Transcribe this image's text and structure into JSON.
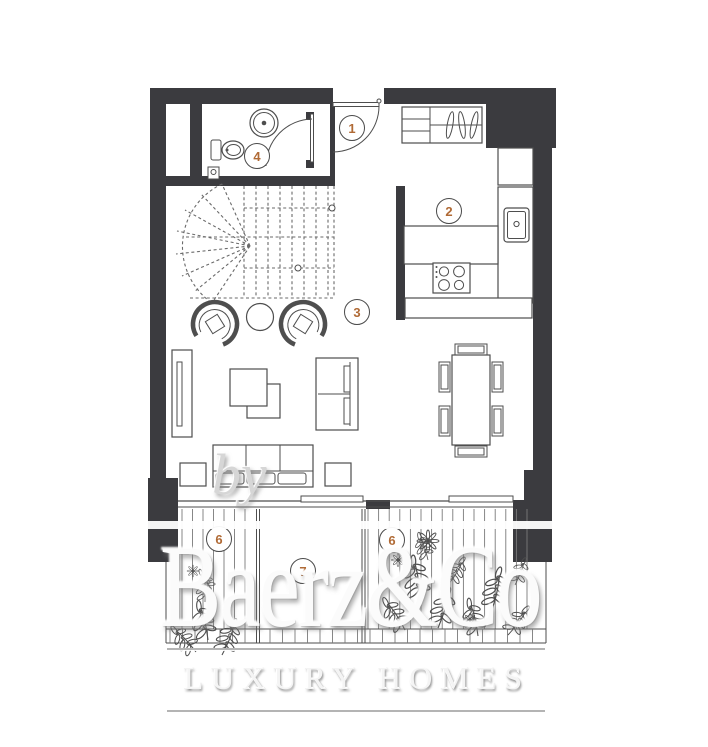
{
  "watermark": {
    "prefix": "by",
    "brand": "Baerz&Co",
    "tagline": "LUXURY HOMES"
  },
  "room_labels": [
    {
      "number": "1",
      "name": "entrance-hall"
    },
    {
      "number": "2",
      "name": "kitchen"
    },
    {
      "number": "3",
      "name": "living-room"
    },
    {
      "number": "4",
      "name": "bathroom"
    },
    {
      "number": "6",
      "name": "balcony-left"
    },
    {
      "number": "6",
      "name": "balcony-right"
    },
    {
      "number": "7",
      "name": "terrace-middle"
    }
  ],
  "colors": {
    "wall": "#3b3b3f",
    "furniture_line": "#4e4e4e",
    "stair_line": "#6a6a6a",
    "label_digit": "#b06a35",
    "label_ring": "#4a4a4a",
    "watermark_rule": "#b4b4b4"
  },
  "fixtures": [
    "spiral-staircase",
    "toilet",
    "washbasin",
    "entry-door",
    "bathroom-door",
    "wardrobe-hangers",
    "kitchen-sink",
    "stove",
    "kitchen-counter",
    "kitchen-island",
    "tv-unit",
    "armchair",
    "round-side-table",
    "coffee-tables",
    "loveseat",
    "sofa",
    "side-table",
    "dining-table",
    "dining-chairs",
    "deck-boards",
    "railing",
    "plants",
    "flowers"
  ]
}
